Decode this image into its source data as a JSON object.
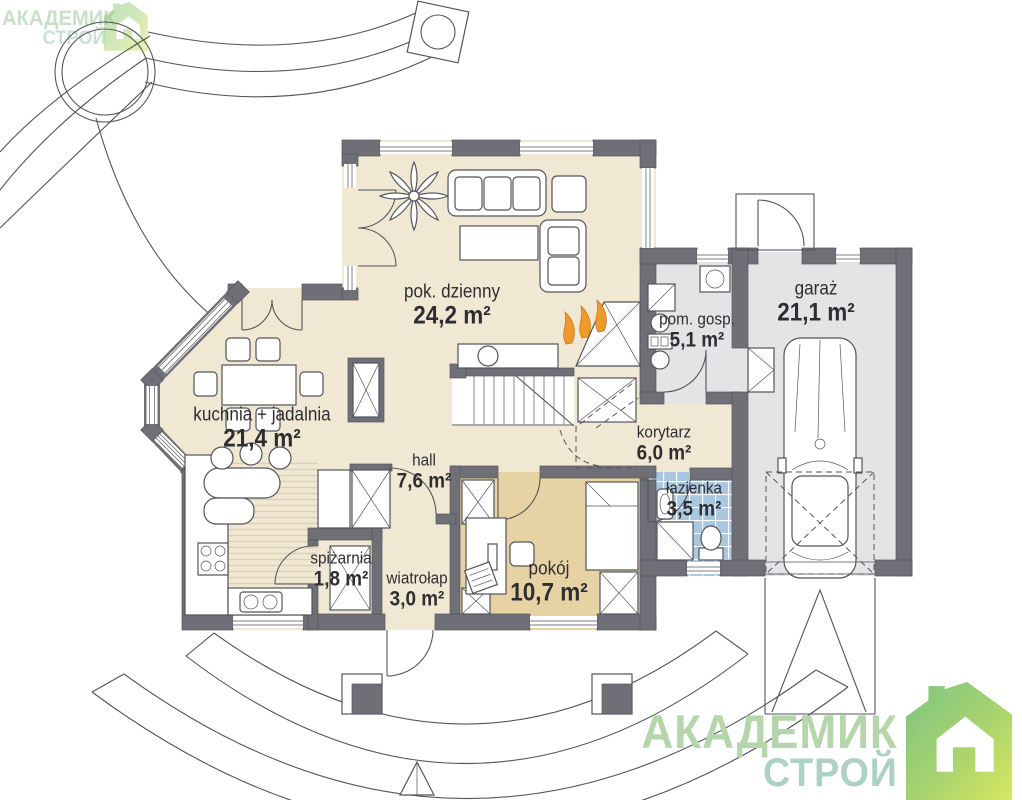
{
  "brand": {
    "line1": "АКАДЕМИК",
    "line2": "СТРОЙ"
  },
  "watermark": {
    "line1": "АКАДЕМИК",
    "line2": "СТРОЙ"
  },
  "rooms": {
    "living": {
      "name": "pok. dzienny",
      "area": "24,2 m²"
    },
    "kitchen": {
      "name": "kuchnia + jadalnia",
      "area": "21,4 m²"
    },
    "hall": {
      "name": "hall",
      "area": "7,6 m²"
    },
    "pantry": {
      "name": "spiżarnia",
      "area": "1,8 m²"
    },
    "vestibule": {
      "name": "wiatrołap",
      "area": "3,0 m²"
    },
    "room": {
      "name": "pokój",
      "area": "10,7 m²"
    },
    "corridor": {
      "name": "korytarz",
      "area": "6,0 m²"
    },
    "bathroom": {
      "name": "łazienka",
      "area": "3,5 m²"
    },
    "utility": {
      "name": "pom. gosp.",
      "area": "5,1 m²"
    },
    "garage": {
      "name": "garaż",
      "area": "21,1 m²"
    }
  },
  "colors": {
    "wall": "#6f6f77",
    "line": "#54545b",
    "cream": "#f1e8d4",
    "tan": "#e7d2a4",
    "tile": "#a9c7e0",
    "gray": "#e4e4e7",
    "stripe": "#ddd0b2",
    "flame": "#ef982c",
    "brand_green_1": "#b5d6ab",
    "brand_green_2": "#aed1c5",
    "watermark_green": "#9cc79b",
    "logo_grad_start": "#7ec382",
    "logo_grad_mid": "#a8d36f",
    "logo_grad_end": "#d8e75f"
  }
}
